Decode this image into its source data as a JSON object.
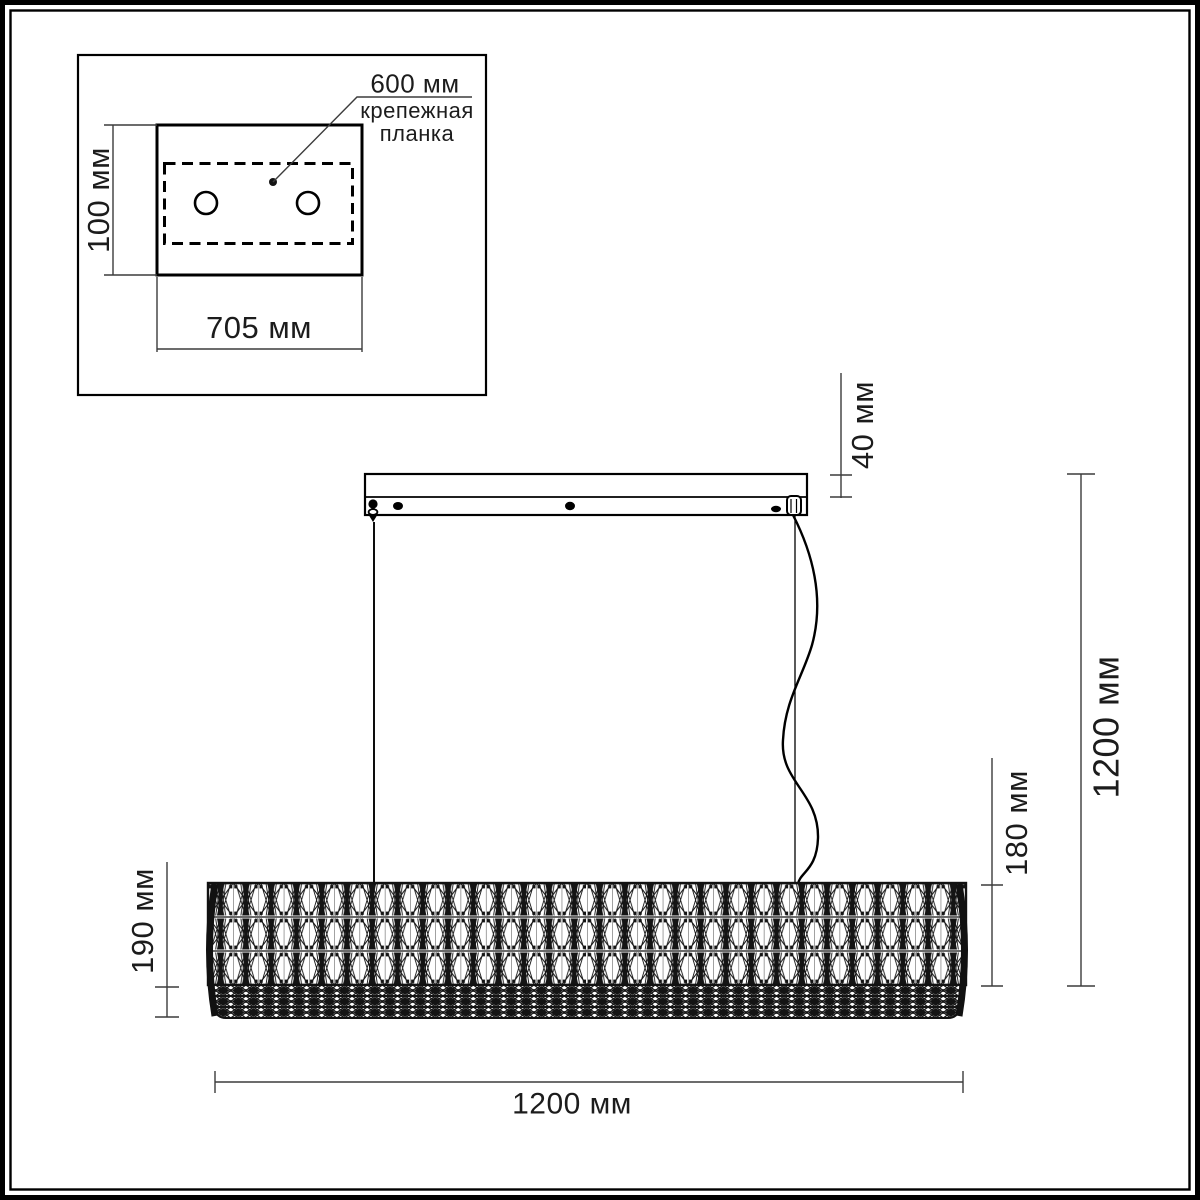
{
  "page": {
    "background": "#ffffff",
    "line_color": "#141414",
    "dim_color": "#3c3c3c"
  },
  "inset": {
    "callout_value": "600 мм",
    "callout_label": "крепежная планка",
    "height_dim": "100 мм",
    "width_dim": "705 мм"
  },
  "main": {
    "canopy_height_dim": "40 мм",
    "overall_height_dim": "1200 мм",
    "shade_height_dim": "180 мм",
    "shade_diameter_dim": "190 мм",
    "length_dim": "1200 мм"
  }
}
